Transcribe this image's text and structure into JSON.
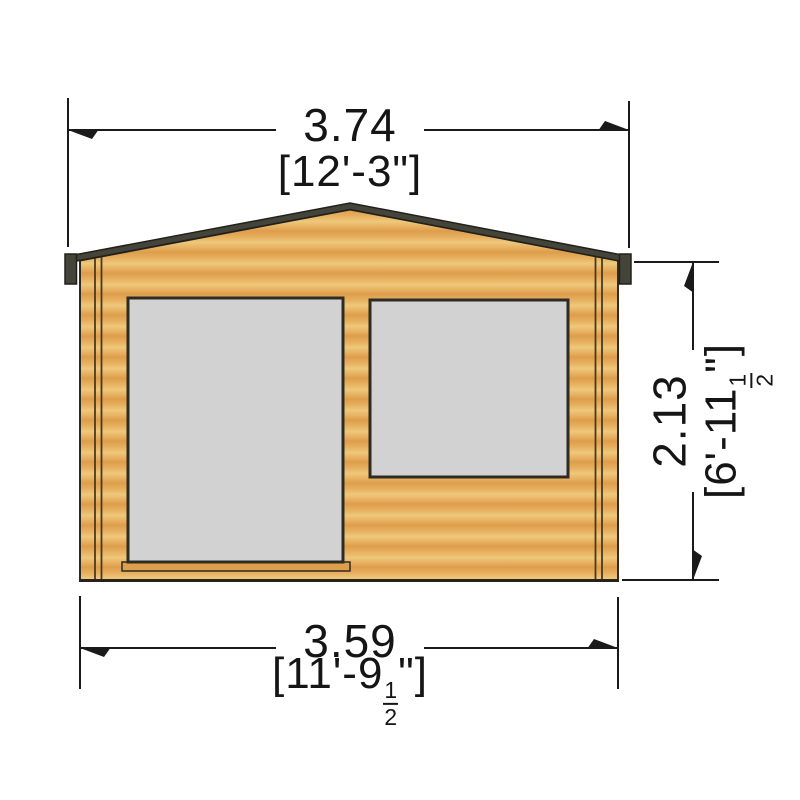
{
  "colors": {
    "background": "#ffffff",
    "wood_light": "#eec87b",
    "wood_mid": "#e7b160",
    "wood_dark": "#dd9e4c",
    "roof": "#45443a",
    "roof_edge": "#21211c",
    "glass": "#d2d2d2",
    "outline": "#2e2b24",
    "dim_line": "#1a1a1a",
    "text": "#151515"
  },
  "dimensions": {
    "top_width": {
      "metric": "3.74",
      "imperial": "[12'-3\"]"
    },
    "bottom_width": {
      "metric": "3.59",
      "imperial_prefix": "[11'-9",
      "fraction_numerator": "1",
      "fraction_denominator": "2",
      "imperial_suffix": "\"]"
    },
    "right_height": {
      "metric": "2.13",
      "imperial_prefix": "[6'-11",
      "fraction_numerator": "1",
      "fraction_denominator": "2",
      "imperial_suffix": "\"]"
    }
  }
}
